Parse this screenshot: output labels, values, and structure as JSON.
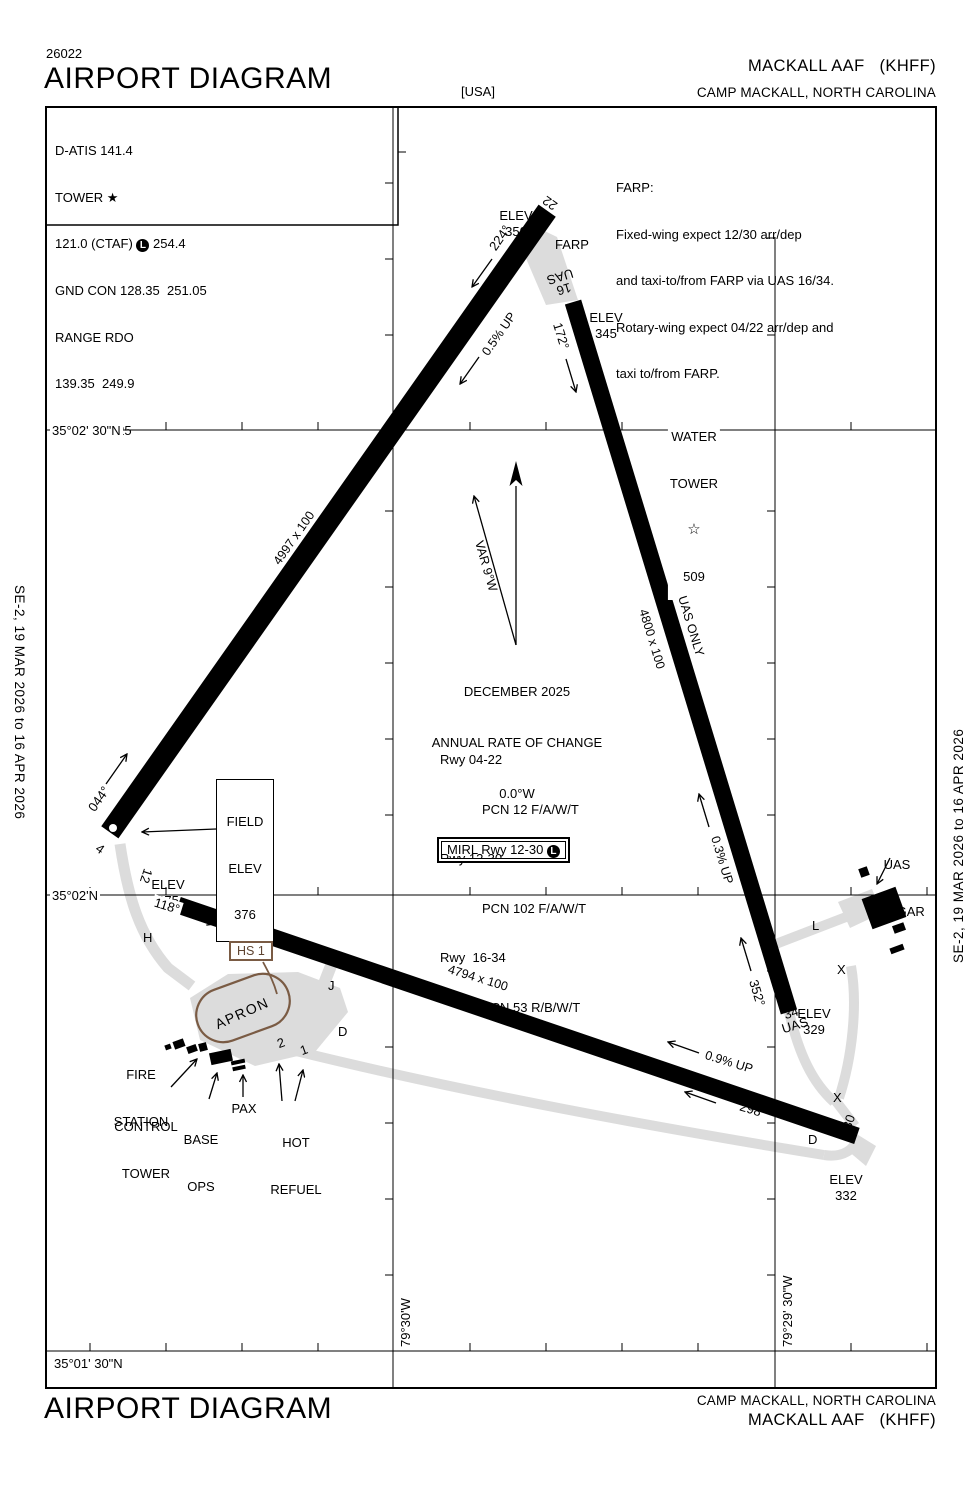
{
  "page": {
    "chart_code": "26022",
    "title_top": "AIRPORT DIAGRAM",
    "title_bottom": "AIRPORT DIAGRAM",
    "region": "[USA]",
    "airport": "MACKALL AAF   (KHFF)",
    "city": "CAMP MACKALL, NORTH CAROLINA",
    "margin_note": "SE-2,  19 MAR 2026  to  16 APR 2026"
  },
  "comms": {
    "datis": "D-ATIS 141.4",
    "tower": "TOWER ★",
    "ctaf_left": "121.0 (CTAF)",
    "l_symbol": "L",
    "ctaf_right": "254.4",
    "gnd": "GND CON 128.35  251.05",
    "range1": "RANGE RDO",
    "range2": "139.35  249.9",
    "ptd": "PTD 395.225"
  },
  "farp_note": {
    "l1": "FARP:",
    "l2": "Fixed-wing expect 12/30 arr/dep",
    "l3": "and taxi-to/from FARP via UAS 16/34.",
    "l4": "Rotary-wing expect 04/22 arr/dep and",
    "l5": "taxi to/from FARP."
  },
  "variation": {
    "label": "VAR 9°W",
    "date": "DECEMBER 2025",
    "rate_l1": "ANNUAL RATE OF CHANGE",
    "rate_l2": "0.0°W"
  },
  "pcn": {
    "l1": "Rwy 04-22",
    "l2": "PCN 12 F/A/W/T",
    "l3": "Rwy 12-30",
    "l4": "PCN 102 F/A/W/T",
    "l5": "Rwy  16-34",
    "l6": "PCN 53 R/B/W/T"
  },
  "lighting": {
    "mirl": "MIRL Rwy 12-30",
    "l_symbol": "L"
  },
  "field_elev": {
    "l1": "FIELD",
    "l2": "ELEV",
    "l3": "376"
  },
  "water_tower": {
    "l1": "WATER",
    "l2": "TOWER",
    "star": "☆",
    "elev": "509"
  },
  "elevs": {
    "e350": {
      "t": "ELEV",
      "v": "350"
    },
    "e345": {
      "t": "ELEV",
      "v": "345"
    },
    "e375": {
      "t": "ELEV",
      "v": "375"
    },
    "e329": {
      "t": "ELEV",
      "v": "329"
    },
    "e332": {
      "t": "ELEV",
      "v": "332"
    }
  },
  "runways": {
    "r0422": {
      "dim": "4997 x 100",
      "hdg_low": "044°",
      "hdg_high": "224°",
      "slope": "0.5% UP",
      "num_low": "4",
      "num_high": "22"
    },
    "r1230": {
      "dim": "4794 x 100",
      "hdg_low": "118°",
      "hdg_high": "298°",
      "slope": "0.9% UP",
      "num_low": "12",
      "num_high": "30"
    },
    "r1634": {
      "dim": "4800 x 100",
      "note": "UAS ONLY",
      "hdg_low": "172°",
      "hdg_high": "352°",
      "slope": "0.3% UP",
      "num16": {
        "l1": "16",
        "l2": "UAS"
      },
      "num34": {
        "l1": "34",
        "l2": "UAS"
      }
    }
  },
  "taxiways": {
    "h": "H",
    "j": "J",
    "d": "D",
    "l": "L",
    "x": "X",
    "apron": "APRON",
    "farp": "FARP",
    "pad2": "2",
    "pad1": "1",
    "hs1": "HS 1"
  },
  "buildings": {
    "fire_l1": "FIRE",
    "fire_l2": "STATION",
    "ct_l1": "CONTROL",
    "ct_l2": "TOWER",
    "ops_l1": "BASE",
    "ops_l2": "OPS",
    "pax": "PAX",
    "hot_l1": "HOT",
    "hot_l2": "REFUEL",
    "hangar_l1": "UAS",
    "hangar_l2": "HANGAR"
  },
  "grid": {
    "lat_top": "35°02' 30\"N",
    "lat_mid": "35°02'N",
    "lat_bottom": "35°01' 30\"N",
    "lon_left": "79°30'W",
    "lon_right": "79°29' 30\"W"
  },
  "colors": {
    "ink": "#000000",
    "taxiway": "#DCDCDC",
    "hotspot": "#7A5B44"
  }
}
